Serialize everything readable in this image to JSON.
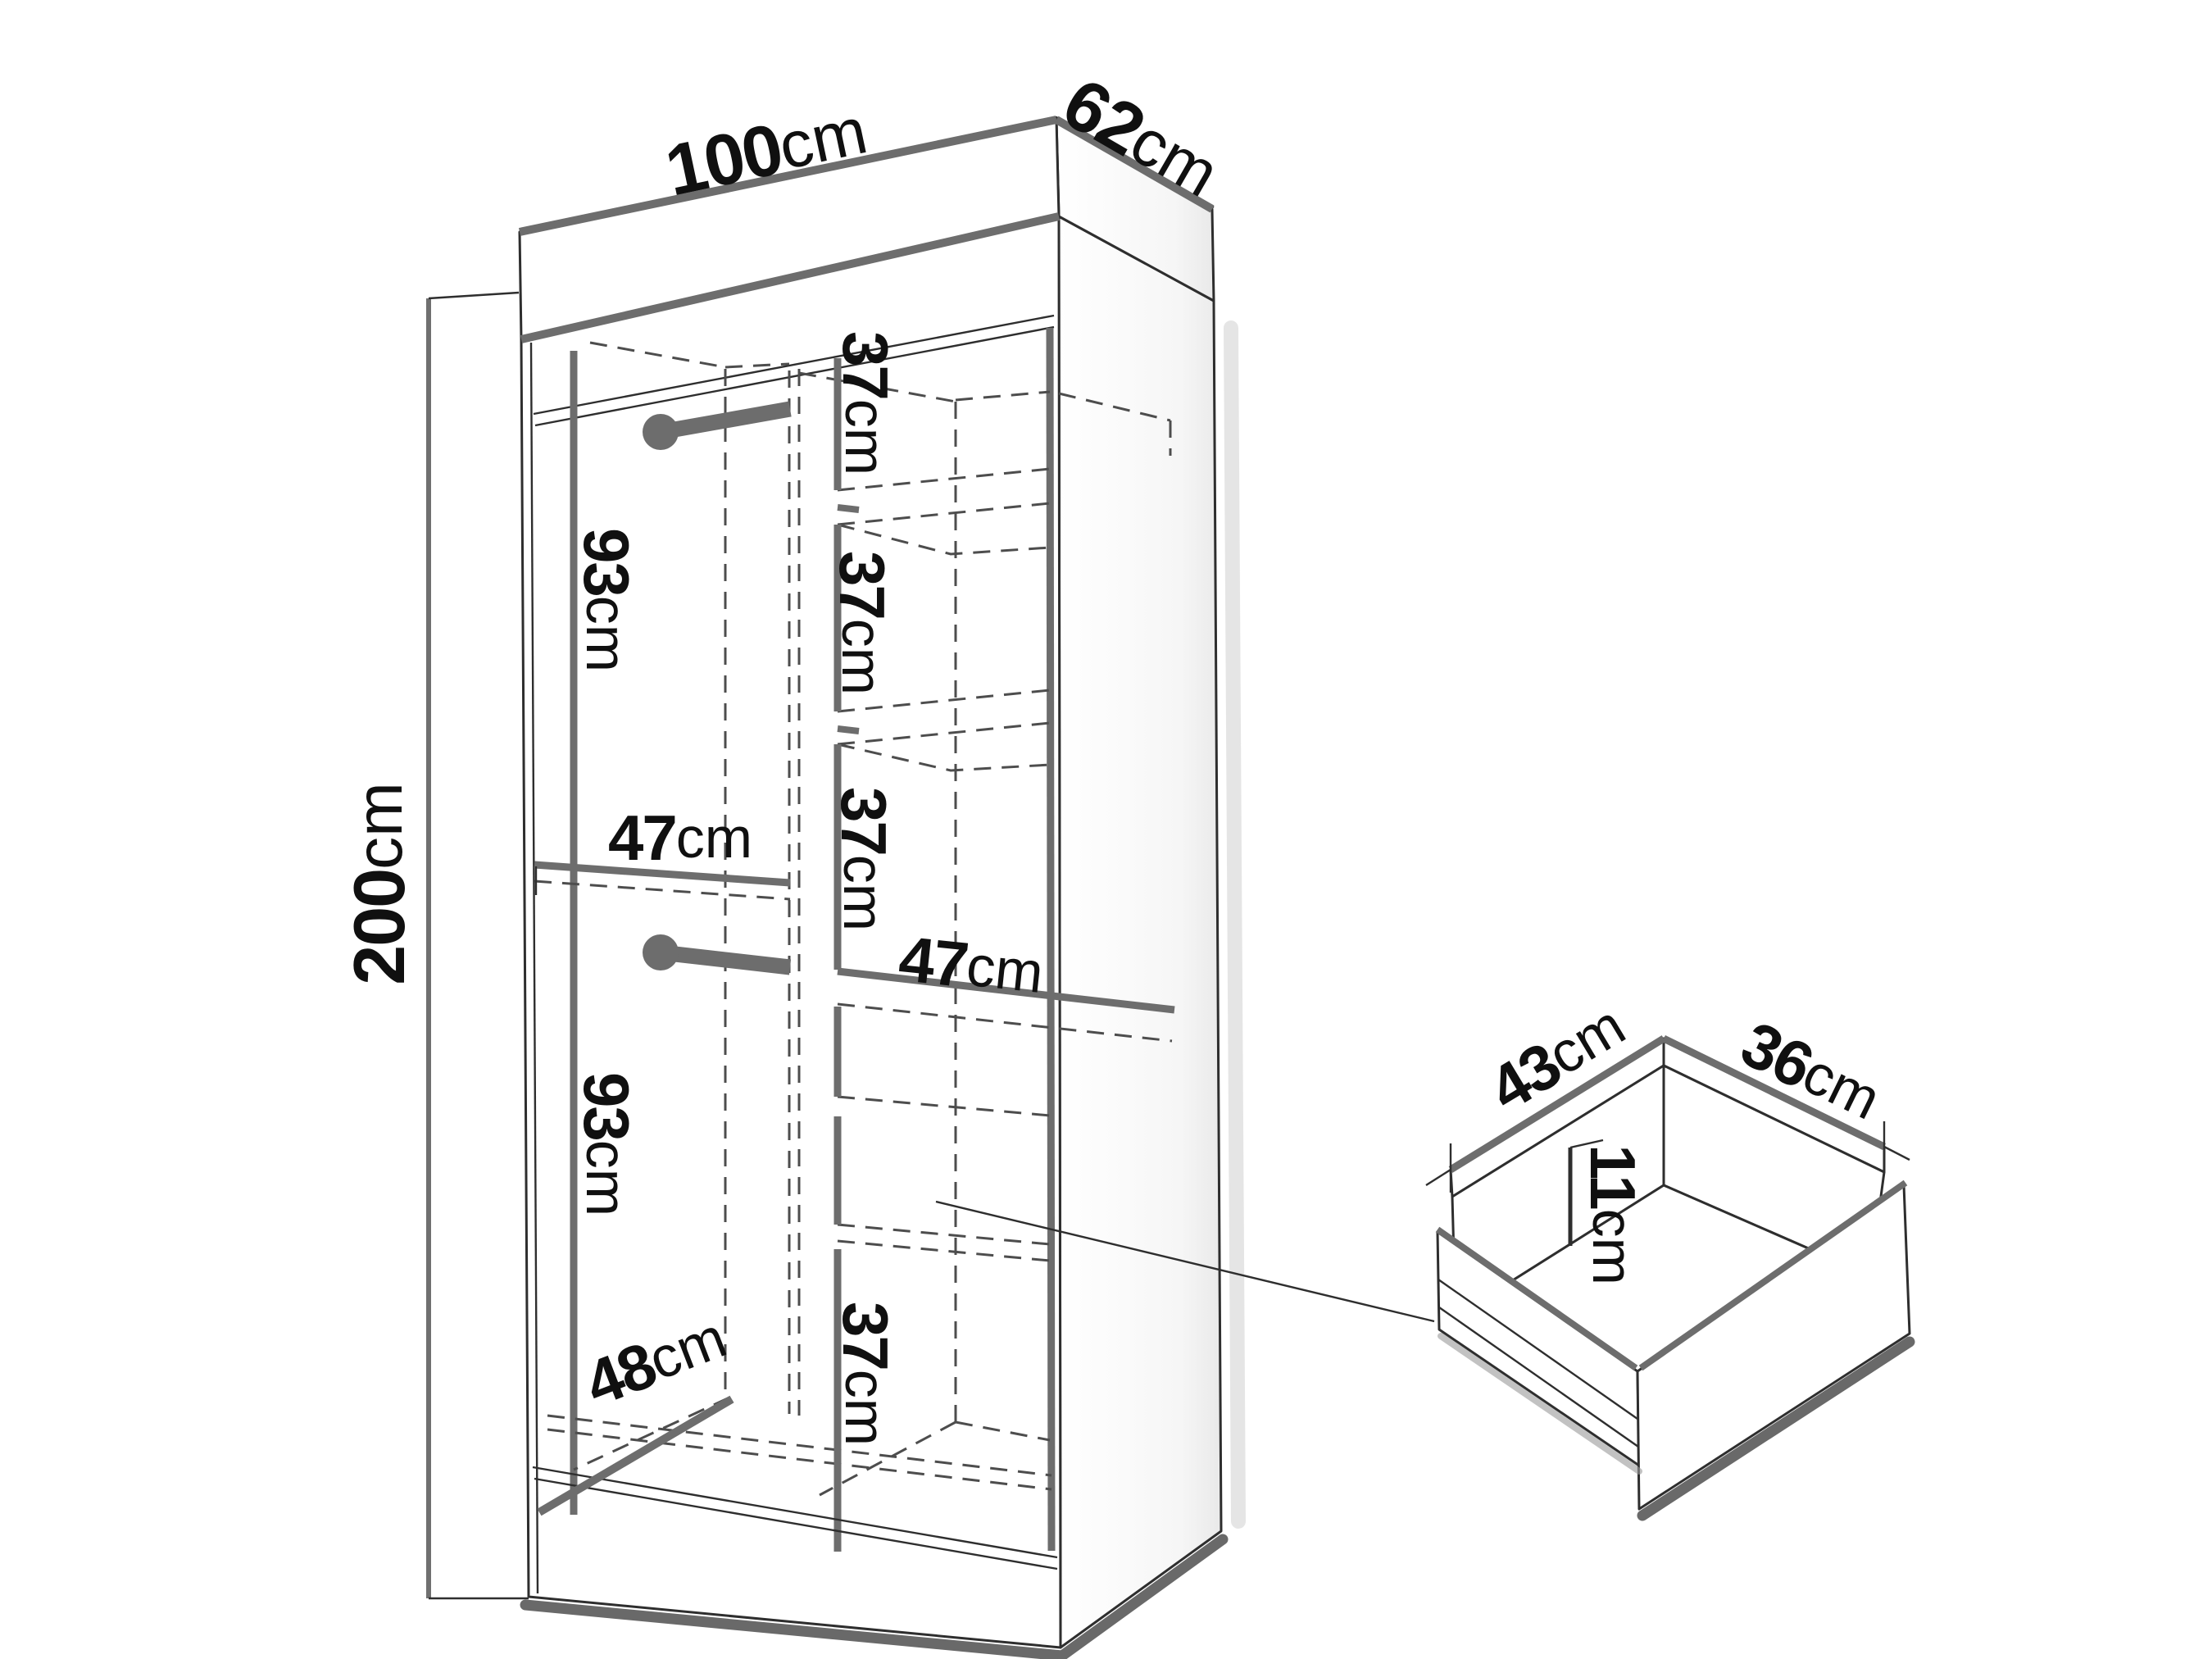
{
  "diagram": {
    "kind": "furniture-dimension-diagram",
    "items": [
      "wardrobe",
      "drawer"
    ]
  },
  "dims": {
    "width": {
      "value": "100",
      "unit": "cm"
    },
    "depth": {
      "value": "62",
      "unit": "cm"
    },
    "height": {
      "value": "200",
      "unit": "cm"
    },
    "shelf_gap_1": {
      "value": "37",
      "unit": "cm"
    },
    "shelf_gap_2": {
      "value": "37",
      "unit": "cm"
    },
    "shelf_gap_3": {
      "value": "37",
      "unit": "cm"
    },
    "bottom_section": {
      "value": "37",
      "unit": "cm"
    },
    "hanging_top": {
      "value": "93",
      "unit": "cm"
    },
    "hanging_bottom": {
      "value": "93",
      "unit": "cm"
    },
    "left_shelf_width": {
      "value": "47",
      "unit": "cm"
    },
    "right_shelf_width": {
      "value": "47",
      "unit": "cm"
    },
    "interior_depth": {
      "value": "48",
      "unit": "cm"
    },
    "drawer_depth": {
      "value": "43",
      "unit": "cm"
    },
    "drawer_width": {
      "value": "36",
      "unit": "cm"
    },
    "drawer_height": {
      "value": "11",
      "unit": "cm"
    }
  },
  "colors": {
    "line": "#2e2e2e",
    "thick_edge": "#6d6d6d",
    "hidden_dash": "#4d4d4d",
    "text": "#101010",
    "background": "#ffffff"
  }
}
